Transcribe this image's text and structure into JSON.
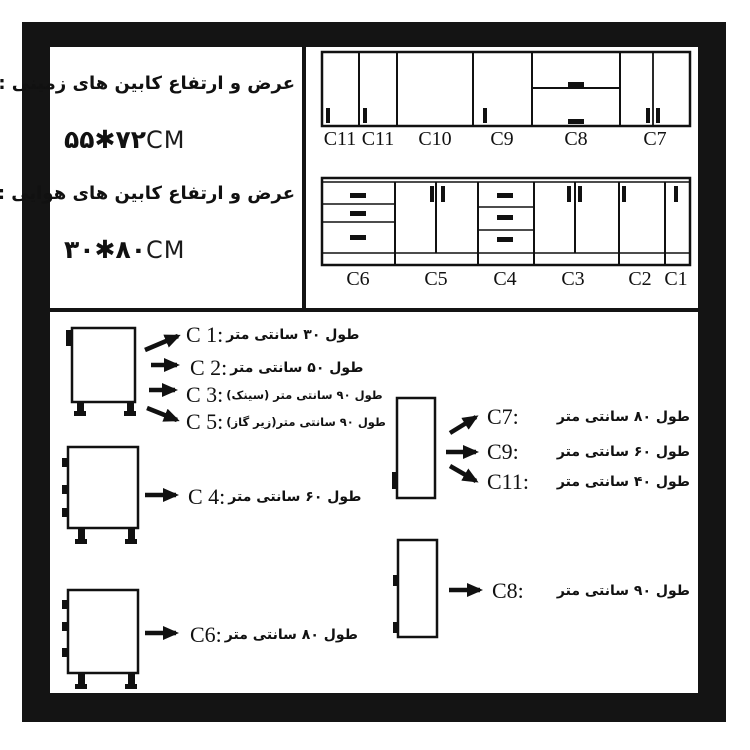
{
  "colors": {
    "ink": "#111111",
    "paper": "#ffffff"
  },
  "specs": {
    "floor_title": "عرض و ارتفاع کابین های زمینی :",
    "floor_size": "۵۵✱۷۲",
    "floor_unit": "CM",
    "wall_title": "عرض و ارتفاع کابین های هوایی :",
    "wall_size": "۳۰✱۸۰",
    "wall_unit": "CM"
  },
  "elevation": {
    "wall_labels": [
      "C11",
      "C11",
      "C10",
      "C9",
      "C8",
      "C7"
    ],
    "base_labels": [
      "C6",
      "C5",
      "C4",
      "C3",
      "C2",
      "C1"
    ]
  },
  "legend": {
    "single_door_group": [
      {
        "code": "C 1:",
        "desc": "طول ۳۰ سانتی متر"
      },
      {
        "code": "C 2:",
        "desc": "طول ۵۰ سانتی متر"
      },
      {
        "code": "C 3:",
        "desc": "طول ۹۰ سانتی متر (سینک)"
      },
      {
        "code": "C 5:",
        "desc": "طول ۹۰ سانتی متر(زیر گاز)"
      }
    ],
    "drawer60": {
      "code": "C 4:",
      "desc": "طول ۶۰ سانتی متر"
    },
    "drawer80": {
      "code": "C6:",
      "desc": "طول ۸۰ سانتی متر"
    },
    "wall_group": [
      {
        "code": "C7:",
        "desc": "طول ۸۰ سانتی متر"
      },
      {
        "code": "C9:",
        "desc": "طول ۶۰ سانتی متر"
      },
      {
        "code": "C11:",
        "desc": "طول ۴۰ سانتی متر"
      }
    ],
    "wall90": {
      "code": "C8:",
      "desc": "طول ۹۰ سانتی متر"
    }
  }
}
